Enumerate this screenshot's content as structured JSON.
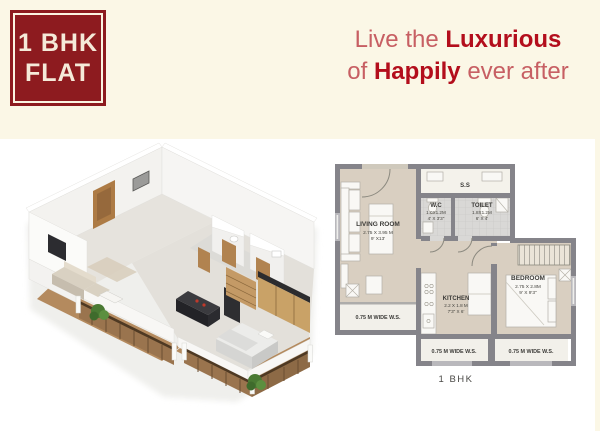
{
  "badge": {
    "line1": "1 BHK",
    "line2": "FLAT"
  },
  "headline": {
    "line1_regular": "Live the ",
    "line1_bold": "Luxurious",
    "line2_regular_a": "of ",
    "line2_bold": "Happily",
    "line2_regular_b": " ever after"
  },
  "floorplan": {
    "caption": "1 BHK",
    "living": {
      "name": "LIVING ROOM",
      "metric": "2.75 X 3.95 M",
      "imperial": "9' X13'"
    },
    "wc": {
      "name": "W.C",
      "metric": "1.0X1.2M",
      "imperial": "4' X 3'3\""
    },
    "toilet": {
      "name": "TOILET",
      "metric": "1.8X1.2M",
      "imperial": "6' X 4'"
    },
    "kitchen": {
      "name": "KITCHEN",
      "metric": "2.2 X 1.8 M",
      "imperial": "7'3\" X 6'"
    },
    "bedroom": {
      "name": "BEDROOM",
      "metric": "2.75 X 2.8M",
      "imperial": "9' X 9'3\""
    },
    "service_slab": "S.S",
    "ws_left": "0.75 M WIDE W.S.",
    "ws_bottom_left": "0.75 M WIDE W.S.",
    "ws_bottom_right": "0.75 M WIDE W.S."
  },
  "colors": {
    "accent_maroon": "#8d1b1f",
    "headline_light": "#c75f63",
    "headline_bold": "#b30e1c",
    "page_bg": "#fbf7e6",
    "wall_gray": "#85848a",
    "floor_beige": "#d9cfc1",
    "balcony_wood": "#9a744e"
  }
}
